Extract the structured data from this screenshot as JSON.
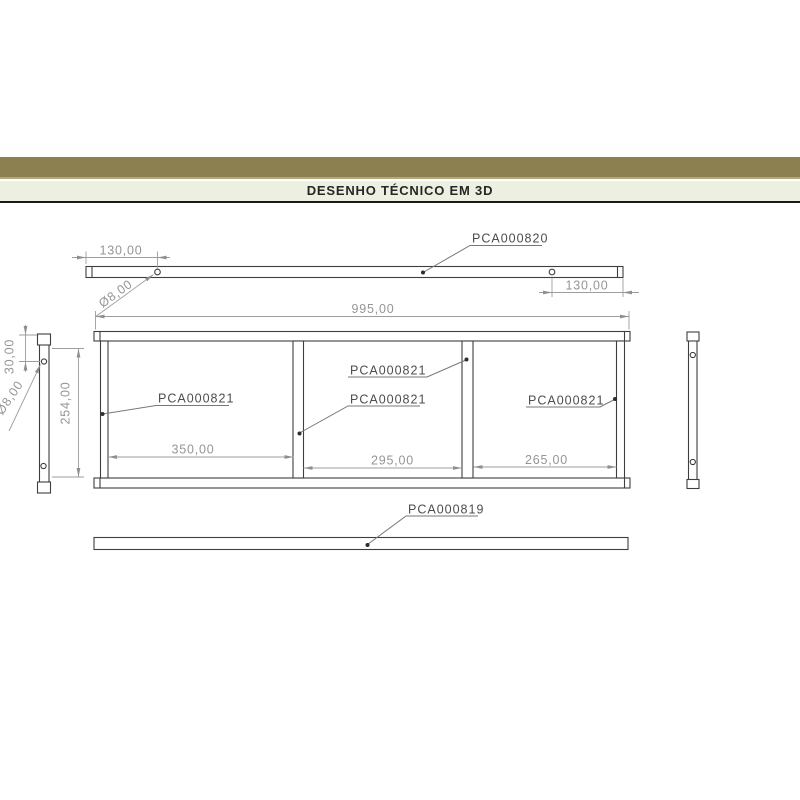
{
  "header": {
    "title": "DESENHO TÉCNICO EM 3D"
  },
  "part_labels": {
    "top_bar": "PCA000820",
    "cross_member": "PCA000821",
    "bottom_bar": "PCA000819"
  },
  "dimensions": {
    "top_hole_offset_left": "130,00",
    "top_hole_offset_right": "130,00",
    "frame_width": "995,00",
    "frame_height": "254,00",
    "side_hole_offset": "30,00",
    "hole_diameter_top": "Ø8,00",
    "hole_diameter_side": "Ø8,00",
    "bay_1_width": "350,00",
    "bay_2_width": "295,00",
    "bay_3_width": "265,00"
  },
  "colors": {
    "band_olive": "#8C7F50",
    "band_light": "#EDF0E1",
    "geometry_line": "#3E3E3E",
    "dimension_gray": "#9D9D9D",
    "label_gray": "#4D4D4D"
  }
}
